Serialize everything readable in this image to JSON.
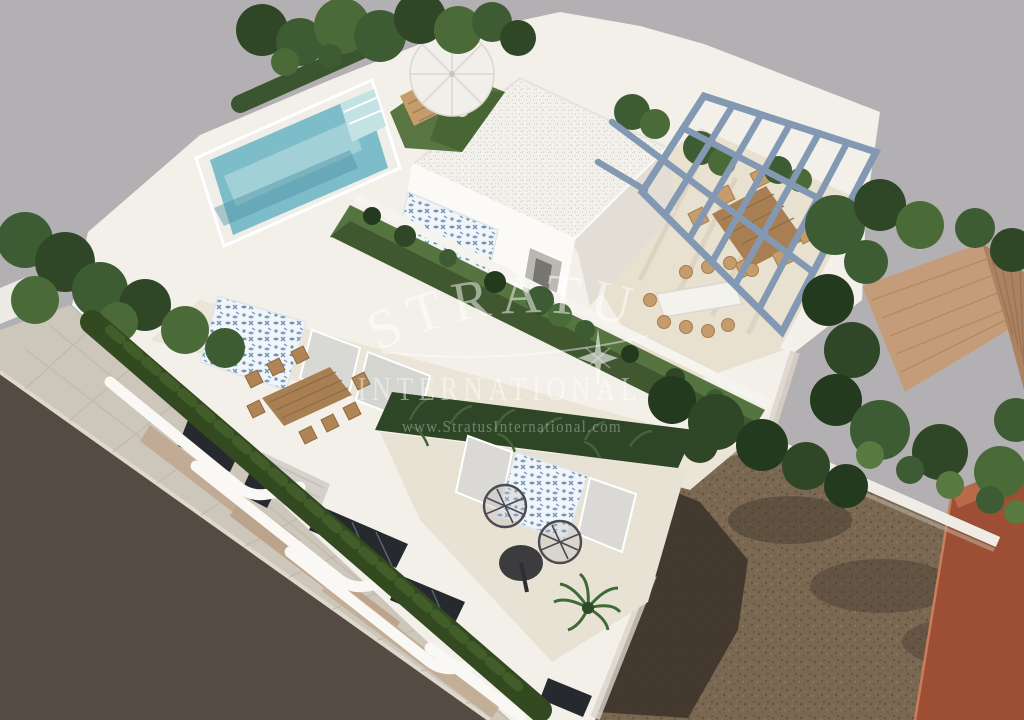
{
  "watermark": {
    "brand_line1": "STRATUS",
    "brand_line2": "INTERNATIONAL",
    "website": "www.StratusInternational.com"
  },
  "colors": {
    "background": "#b3b0b3",
    "villa_white": "#f3f0ea",
    "terrace_floor": "#ebe5d7",
    "lower_floor": "#e8e2d4",
    "pergola_floor": "#e9e1d0",
    "pool_water": "#7dbcc9",
    "pool_steps": "#c2e2e4",
    "lawn": "#587542",
    "roof_garden": "#567440",
    "foliage_dark": "#2e4526",
    "pergola_steel": "#8398b3",
    "terracotta_roof": "#c59c79",
    "terracotta_shade": "#ab8262",
    "road": "#554b42",
    "sidewalk": "#cdc6bb",
    "soil": "#7b6853",
    "soil_shadow": "#3f352b",
    "neighbor_building": "#9c4f35",
    "wood": "#a87f52",
    "tile_blue": "#6f93ba",
    "window_dark": "#26292e"
  }
}
